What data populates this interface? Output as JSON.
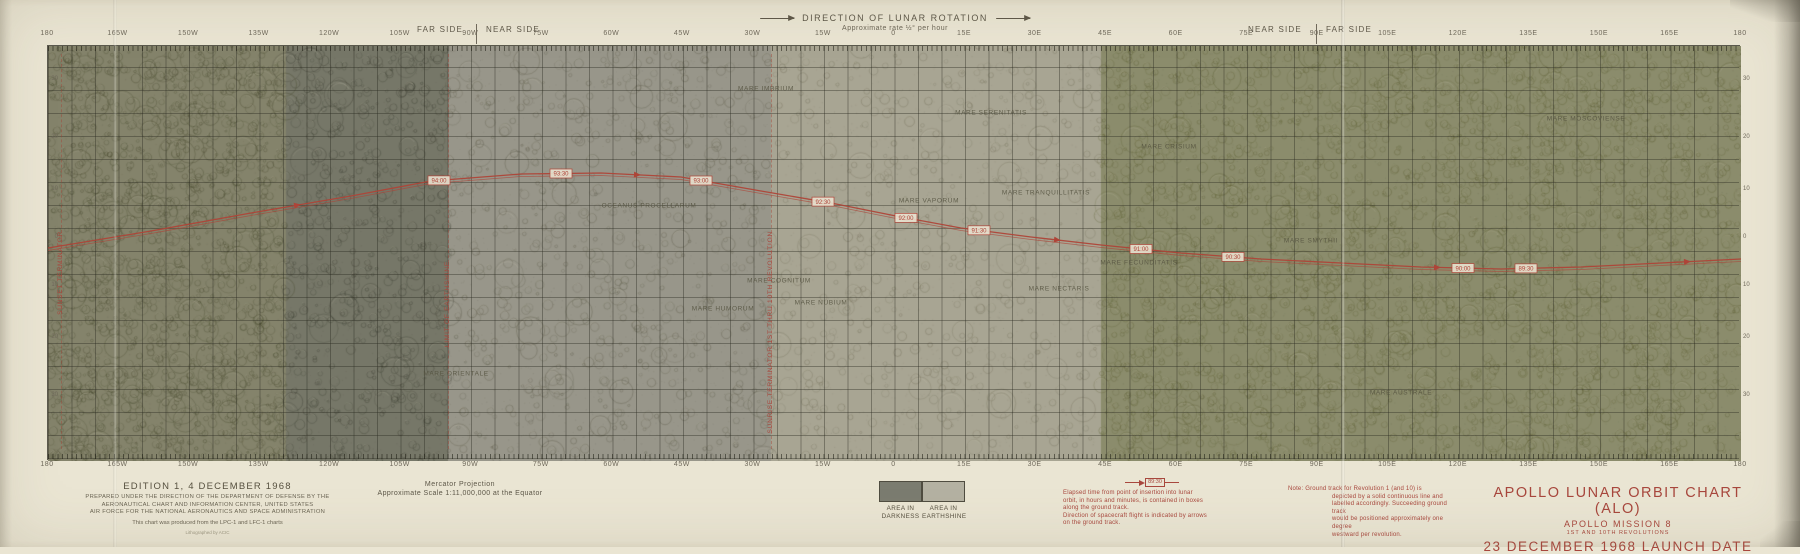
{
  "colors": {
    "paper": "#eae5d3",
    "red_accent": "#a8473d",
    "track_red": "#ae4438",
    "ink": "#57503f",
    "legend_dark_swatch": "#7b7c70",
    "legend_light_swatch": "#b4b1a2"
  },
  "header": {
    "direction_title": "DIRECTION OF LUNAR ROTATION",
    "direction_subtitle": "Approximate rate ½° per hour",
    "left_far_side": "FAR SIDE",
    "left_near_side": "NEAR SIDE",
    "right_near_side": "NEAR SIDE",
    "right_far_side": "FAR SIDE"
  },
  "axes": {
    "longitude_labels": [
      "180",
      "165W",
      "150W",
      "135W",
      "120W",
      "105W",
      "90W",
      "75W",
      "60W",
      "45W",
      "30W",
      "15W",
      "0",
      "15E",
      "30E",
      "45E",
      "60E",
      "75E",
      "90E",
      "105E",
      "120E",
      "135E",
      "150E",
      "165E",
      "180"
    ],
    "latitude_labels": [
      "30",
      "20",
      "10",
      "0",
      "10",
      "20",
      "30"
    ],
    "latitude_y_local": [
      34,
      92,
      144,
      192,
      240,
      292,
      350
    ]
  },
  "map": {
    "features": [
      {
        "name": "MARE IMBRIUM",
        "x": 765,
        "y": 88,
        "rx": 52,
        "ry": 30
      },
      {
        "name": "MARE SERENITATIS",
        "x": 990,
        "y": 112,
        "rx": 28,
        "ry": 24
      },
      {
        "name": "MARE CRISIUM",
        "x": 1168,
        "y": 146,
        "rx": 22,
        "ry": 16
      },
      {
        "name": "MARE TRANQUILLITATIS",
        "x": 1045,
        "y": 192,
        "rx": 36,
        "ry": 26
      },
      {
        "name": "MARE FECUNDITATIS",
        "x": 1138,
        "y": 262,
        "rx": 24,
        "ry": 20
      },
      {
        "name": "MARE NECTARIS",
        "x": 1058,
        "y": 288,
        "rx": 15,
        "ry": 13
      },
      {
        "name": "MARE VAPORUM",
        "x": 928,
        "y": 200,
        "rx": 10,
        "ry": 8
      },
      {
        "name": "MARE NUBIUM",
        "x": 820,
        "y": 302,
        "rx": 26,
        "ry": 16
      },
      {
        "name": "MARE HUMORUM",
        "x": 722,
        "y": 308,
        "rx": 15,
        "ry": 12
      },
      {
        "name": "MARE COGNITUM",
        "x": 778,
        "y": 280,
        "rx": 11,
        "ry": 8
      },
      {
        "name": "OCEANUS PROCELLARUM",
        "x": 648,
        "y": 205,
        "rx": 55,
        "ry": 65
      },
      {
        "name": "MARE ORIENTALE",
        "x": 455,
        "y": 373,
        "rx": 17,
        "ry": 13
      },
      {
        "name": "MARE SMYTHII",
        "x": 1310,
        "y": 240,
        "rx": 15,
        "ry": 12
      },
      {
        "name": "MARE MOSCOVIENSE",
        "x": 1585,
        "y": 118,
        "rx": 13,
        "ry": 10
      },
      {
        "name": "MARE AUSTRALE",
        "x": 1400,
        "y": 392,
        "rx": 19,
        "ry": 13
      }
    ],
    "terminators": [
      {
        "x": 60,
        "label": "SUNSET TERMINATOR",
        "label_y": 230
      },
      {
        "x": 447,
        "label": "LIMIT OF EARTHSHINE",
        "label_y": 260
      },
      {
        "x": 770,
        "label": "SUNRISE TERMINATOR 1ST THRU 10TH REVOLUTION",
        "label_y": 230
      }
    ],
    "track": {
      "points": [
        [
          47,
          247
        ],
        [
          150,
          230
        ],
        [
          250,
          212
        ],
        [
          350,
          195
        ],
        [
          430,
          180
        ],
        [
          520,
          173
        ],
        [
          600,
          172
        ],
        [
          680,
          176
        ],
        [
          760,
          190
        ],
        [
          830,
          202
        ],
        [
          895,
          215
        ],
        [
          960,
          227
        ],
        [
          1030,
          236
        ],
        [
          1100,
          244
        ],
        [
          1180,
          252
        ],
        [
          1260,
          258
        ],
        [
          1340,
          262
        ],
        [
          1420,
          266
        ],
        [
          1500,
          268
        ],
        [
          1580,
          266
        ],
        [
          1660,
          262
        ],
        [
          1740,
          258
        ]
      ],
      "time_boxes": [
        {
          "t": "94:00",
          "x": 438
        },
        {
          "t": "93:30",
          "x": 560
        },
        {
          "t": "93:00",
          "x": 700
        },
        {
          "t": "92:30",
          "x": 822
        },
        {
          "t": "92:00",
          "x": 905
        },
        {
          "t": "91:30",
          "x": 978
        },
        {
          "t": "91:00",
          "x": 1140
        },
        {
          "t": "90:30",
          "x": 1232
        },
        {
          "t": "90:00",
          "x": 1462
        },
        {
          "t": "89:30",
          "x": 1525
        }
      ],
      "arrow_xs": [
        300,
        640,
        1060,
        1440,
        1690
      ]
    }
  },
  "footer": {
    "edition": {
      "line1": "EDITION 1, 4 DECEMBER 1968",
      "fine1": "PREPARED UNDER THE DIRECTION OF THE DEPARTMENT OF DEFENSE BY THE",
      "fine2": "AERONAUTICAL CHART AND INFORMATION CENTER, UNITED STATES",
      "fine3": "AIR FORCE FOR THE NATIONAL AERONAUTICS AND SPACE ADMINISTRATION",
      "produced": "This chart was produced from the LPC-1 and LFC-1 charts",
      "litho": "Lithographed by ACIC"
    },
    "projection": {
      "line1": "Mercator Projection",
      "line2": "Approximate Scale 1:11,000,000 at the Equator"
    },
    "legend": {
      "dark_label_line1": "AREA IN",
      "dark_label_line2": "DARKNESS",
      "light_label_line1": "AREA IN",
      "light_label_line2": "EARTHSHINE"
    },
    "elapsed_note": {
      "sample_time": "89:30",
      "line1": "Elapsed time from point of insertion into lunar",
      "line2": "orbit, in hours and minutes, is contained in boxes",
      "line3": "along the ground track.",
      "line4": "Direction of spacecraft flight is indicated by arrows",
      "line5": "on the ground track."
    },
    "ground_note": {
      "line1": "Note:  Ground track for Revolution 1 (and 10) is",
      "line2": "depicted by a solid continuous line and",
      "line3": "labelled accordingly. Succeeding ground track",
      "line4": "would be positioned approximately one degree",
      "line5": "westward per revolution."
    },
    "title_block": {
      "line1": "APOLLO LUNAR ORBIT CHART (ALO)",
      "line2": "APOLLO MISSION 8",
      "line3": "1ST AND 10TH REVOLUTIONS",
      "line4": "23 DECEMBER 1968 LAUNCH DATE"
    }
  }
}
